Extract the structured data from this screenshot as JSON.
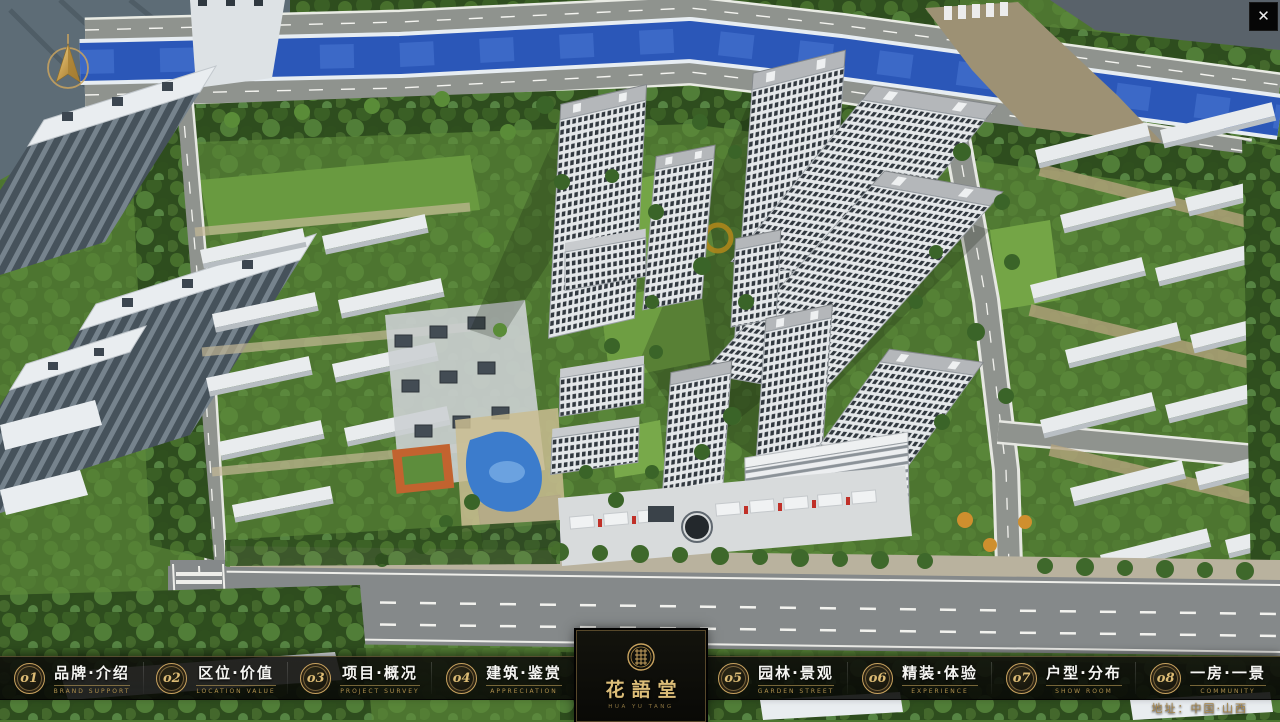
{
  "window": {
    "close_glyph": "✕"
  },
  "colors": {
    "accent_gold": "#c9a35f",
    "nav_bg": "#0d0d0a",
    "river_blue": "#2b57b8"
  },
  "nav": {
    "items_left": [
      {
        "num": "o1",
        "title": "品牌·介绍",
        "subtitle": "BRAND SUPPORT"
      },
      {
        "num": "o2",
        "title": "区位·价值",
        "subtitle": "LOCATION VALUE"
      },
      {
        "num": "o3",
        "title": "项目·概况",
        "subtitle": "PROJECT SURVEY"
      },
      {
        "num": "o4",
        "title": "建筑·鉴赏",
        "subtitle": "APPRECIATION"
      }
    ],
    "items_right": [
      {
        "num": "o5",
        "title": "园林·景观",
        "subtitle": "GARDEN STREET"
      },
      {
        "num": "o6",
        "title": "精装·体验",
        "subtitle": "EXPERIENCE"
      },
      {
        "num": "o7",
        "title": "户型·分布",
        "subtitle": "SHOW ROOM"
      },
      {
        "num": "o8",
        "title": "一房·一景",
        "subtitle": "COMMUNITY"
      }
    ],
    "logo": {
      "name": "花語堂",
      "tagline": "HUA YU TANG"
    },
    "address": "地址：中国·山西"
  }
}
